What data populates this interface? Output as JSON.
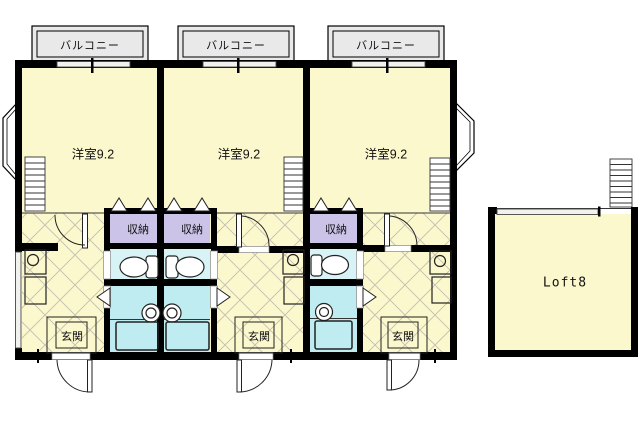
{
  "colors": {
    "wall": "#000000",
    "room": "#fcf8cd",
    "storage": "#cbc3e8",
    "toilet": "#d8f3f6",
    "bath": "#bfecf0",
    "balcony": "#e9e9e9",
    "hatch": "#c2bfb1"
  },
  "units": [
    {
      "balcony": "バルコニー",
      "room": "洋室9.2",
      "storage": "収納",
      "entrance": "玄関"
    },
    {
      "balcony": "バルコニー",
      "room": "洋室9.2",
      "storage": "収納",
      "entrance": "玄関"
    },
    {
      "balcony": "バルコニー",
      "room": "洋室9.2",
      "storage": "収納",
      "entrance": "玄関"
    }
  ],
  "loft": {
    "label": "Loft8"
  }
}
